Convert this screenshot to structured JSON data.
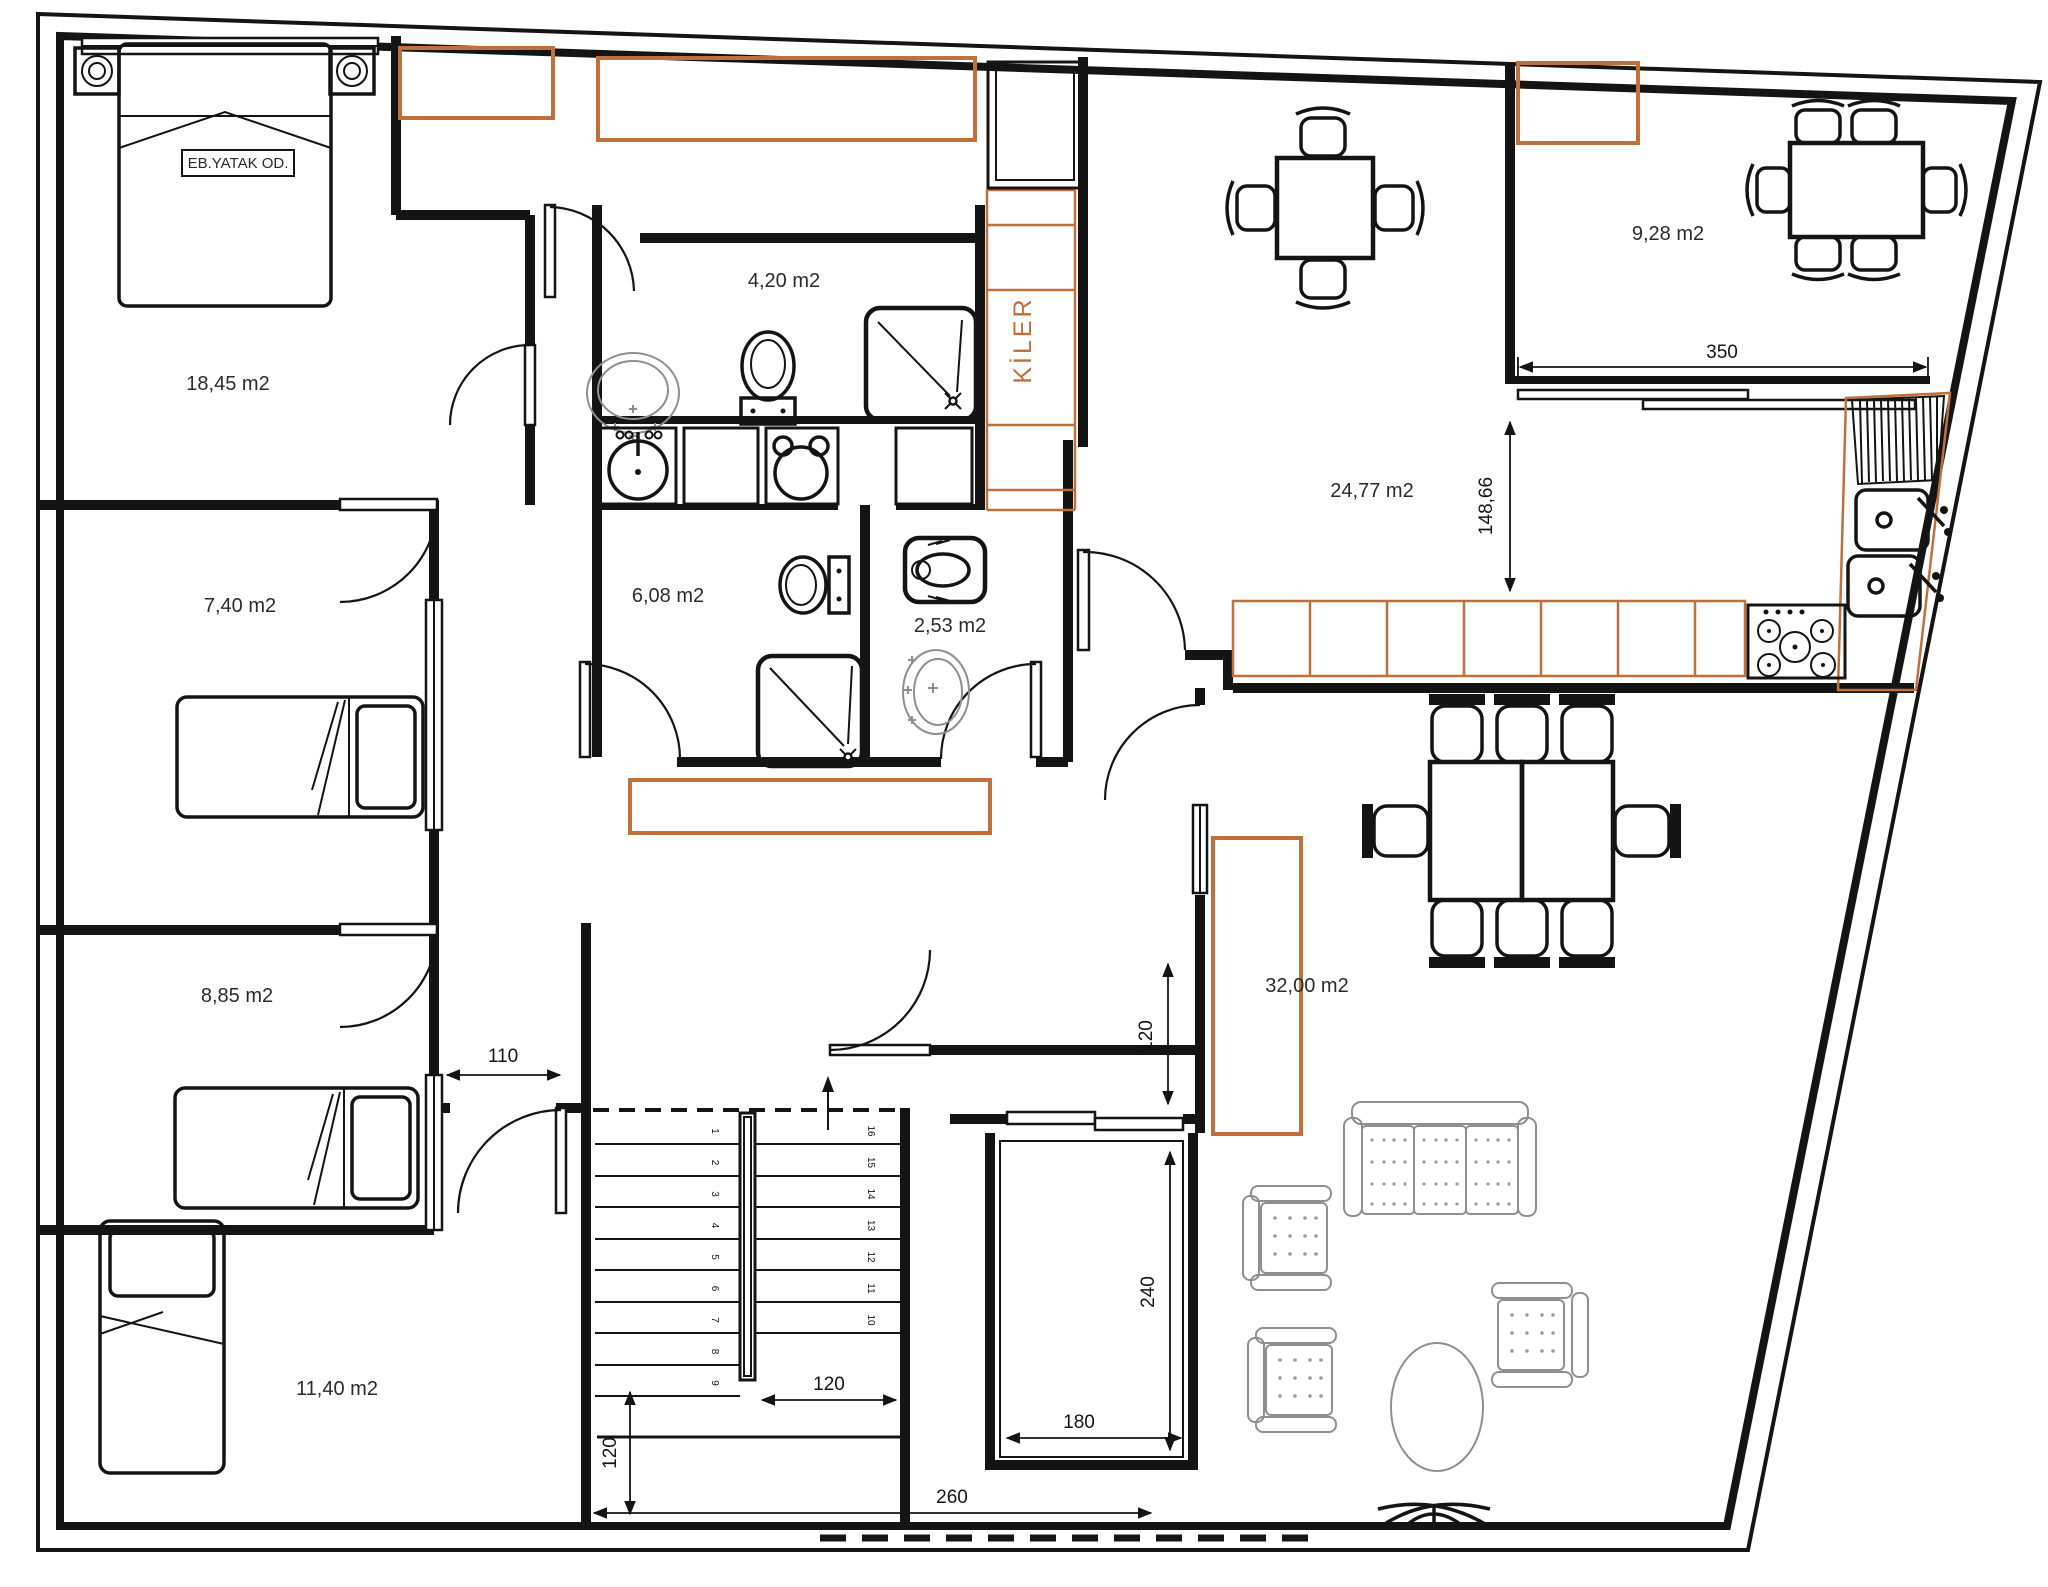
{
  "plan": {
    "type": "architectural-floor-plan",
    "rooms": {
      "master_bedroom": {
        "name_tag": "EB.YATAK OD.",
        "area": "18,45 m2"
      },
      "bathroom_top": {
        "area": "4,20 m2"
      },
      "pantry": {
        "label": "KİLER"
      },
      "balcony_top_right": {
        "area": "9,28 m2"
      },
      "kitchen": {
        "area": "24,77 m2"
      },
      "bedroom_mid_left": {
        "area": "7,40 m2"
      },
      "bathroom_mid": {
        "area": "6,08 m2"
      },
      "wc": {
        "area": "2,53 m2"
      },
      "bedroom_low_left": {
        "area": "8,85 m2"
      },
      "living_room": {
        "area": "32,00 m2"
      },
      "bedroom_bottom_left": {
        "area": "11,40 m2"
      }
    },
    "dimensions": {
      "balcony_width": "350",
      "kitchen_depth": "148,66",
      "corridor_door": "110",
      "stair_depth": "120",
      "stair_width": "260",
      "flight_width": "120",
      "elevator_width": "180",
      "elevator_depth": "240",
      "landing_height": "120"
    },
    "stairs": {
      "left_steps": [
        "1",
        "2",
        "3",
        "4",
        "5",
        "6",
        "7",
        "8",
        "9"
      ],
      "right_steps": [
        "16",
        "15",
        "14",
        "13",
        "12",
        "11",
        "10"
      ]
    },
    "icons": {
      "bed-icon": "double and single beds",
      "toilet-icon": "wc toilet",
      "squat-toilet-icon": "squat toilet",
      "sink-icon": "wash basin",
      "shower-icon": "shower tray",
      "stove-icon": "5-burner cooktop",
      "fridge-icon": "refrigerator cabinet",
      "sofa-icon": "3-seat sofa",
      "armchair-icon": "armchair",
      "dining-table-icon": "dining table with chairs",
      "plant-icon": "plant / palm decoration"
    },
    "colors": {
      "wall": "#141414",
      "cabinet_orange": "#c0703a",
      "fixture_gray": "#8f8f8f",
      "label_text": "#2b2b2b"
    }
  }
}
